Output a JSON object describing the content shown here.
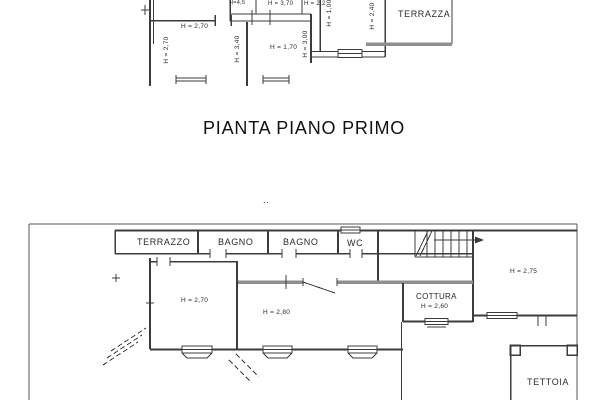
{
  "title": "PIANTA PIANO PRIMO",
  "top_plan": {
    "labels": {
      "h_top_small": "H=4,5",
      "h_370": "H = 3,70",
      "h_right_small": "H = 2,2",
      "h_270_horizontal": "H = 2,70",
      "h_270_vertical": "H = 2,70",
      "h_340_vertical": "H = 3,40",
      "h_170": "H = 1,70",
      "h_300_vertical": "H = 3,00",
      "h_100_vertical": "H = 1,00",
      "h_240_vertical": "H = 2,40",
      "terrazza": "TERRAZZA"
    }
  },
  "bottom_plan": {
    "labels": {
      "dots": "..",
      "terrazzo": "TERRAZZO",
      "bagno_1": "BAGNO",
      "bagno_2": "BAGNO",
      "wc": "WC",
      "h_270": "H = 2,70",
      "h_280": "H = 2,80",
      "cottura": "COTTURA",
      "h_260": "H = 2,60",
      "h_275": "H = 2,75",
      "tettoia": "TETTOIA"
    }
  },
  "colors": {
    "line": "#3c3c3c",
    "gray_wall": "#8f8f8f",
    "border": "#555555",
    "text": "#1f1f1f",
    "background": "#ffffff"
  }
}
